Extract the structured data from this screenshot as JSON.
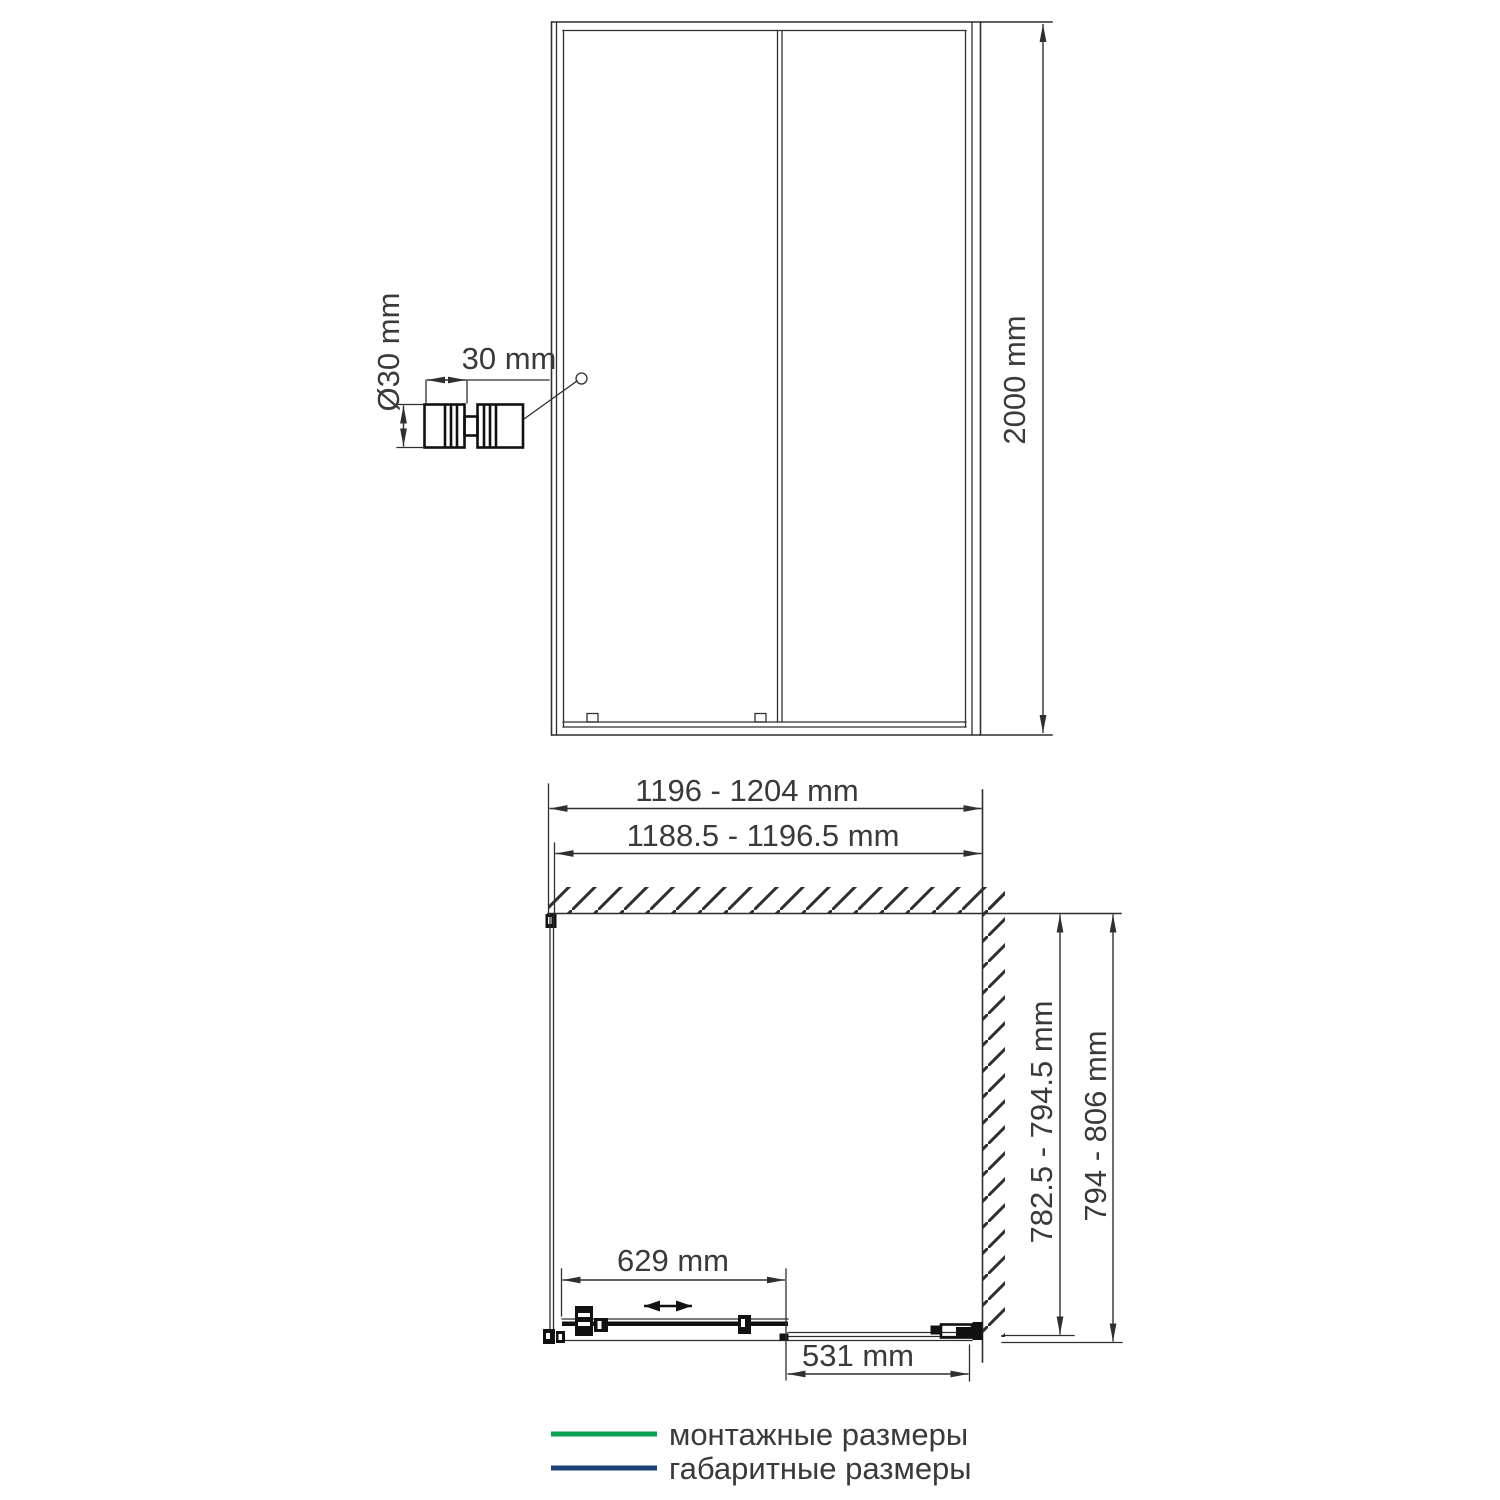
{
  "drawing": {
    "front_view": {
      "height_label": "2000 mm",
      "handle": {
        "diameter_label": "Ø30 mm",
        "depth_label": "30 mm"
      }
    },
    "plan_view": {
      "overall_width_label": "1196 - 1204 mm",
      "mounting_width_label": "1188.5 - 1196.5 mm",
      "mounting_depth_label": "782.5 - 794.5 mm",
      "overall_depth_label": "794 - 806 mm",
      "door_travel_label": "629 mm",
      "fixed_panel_label": "531 mm"
    }
  },
  "legend": {
    "mounting": {
      "label": "монтажные размеры",
      "color": "#0aa155"
    },
    "overall": {
      "label": "габаритные размеры",
      "color": "#1c4078"
    }
  },
  "colors": {
    "mounting": "#0aa155",
    "overall": "#1c4078"
  }
}
